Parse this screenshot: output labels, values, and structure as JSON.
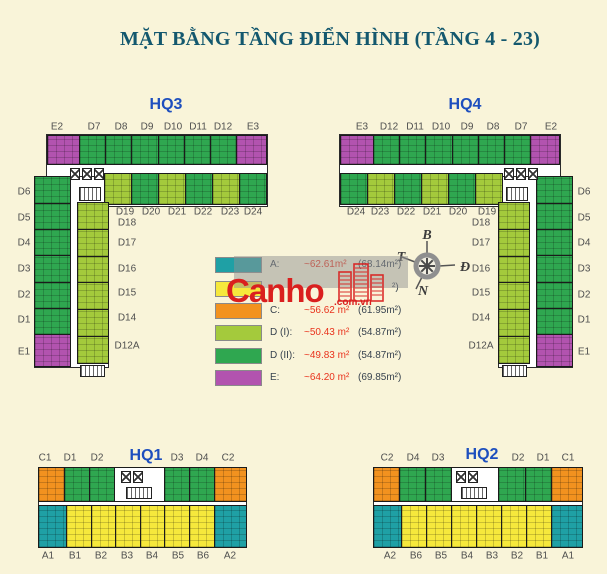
{
  "title": "MẶT BẰNG TẦNG ĐIỂN HÌNH (TẦNG 4 - 23)",
  "colors": {
    "background": "#F9F4D9",
    "title": "#14586E",
    "block_label": "#1E4FBE",
    "unit_label": "#4F4F4F",
    "type_a": "#1FA0A5",
    "type_b": "#F6E83C",
    "type_c": "#F2921F",
    "type_d1": "#A4CA3C",
    "type_d2": "#2FA750",
    "type_e": "#B253AF",
    "legend_value": "#E9331D",
    "legend_paren": "#37424E",
    "watermark_red": "#DA1F1E"
  },
  "blocks": {
    "hq3": {
      "name": "HQ3",
      "top": [
        {
          "id": "E2",
          "type": "e"
        },
        {
          "id": "D7",
          "type": "d2"
        },
        {
          "id": "D8",
          "type": "d2"
        },
        {
          "id": "D9",
          "type": "d2"
        },
        {
          "id": "D10",
          "type": "d2"
        },
        {
          "id": "D11",
          "type": "d2"
        },
        {
          "id": "D12",
          "type": "d2"
        },
        {
          "id": "E3",
          "type": "e"
        }
      ],
      "inner": [
        {
          "id": "D19",
          "type": "d1"
        },
        {
          "id": "D20",
          "type": "d2"
        },
        {
          "id": "D21",
          "type": "d1"
        },
        {
          "id": "D22",
          "type": "d2"
        },
        {
          "id": "D23",
          "type": "d1"
        },
        {
          "id": "D24",
          "type": "d2"
        }
      ],
      "outer": [
        {
          "id": "D6",
          "type": "d2"
        },
        {
          "id": "D5",
          "type": "d2"
        },
        {
          "id": "D4",
          "type": "d2"
        },
        {
          "id": "D3",
          "type": "d2"
        },
        {
          "id": "D2",
          "type": "d2"
        },
        {
          "id": "D1",
          "type": "d2"
        },
        {
          "id": "E1",
          "type": "e"
        }
      ],
      "innerCol": [
        {
          "id": "D18",
          "type": "d1"
        },
        {
          "id": "D17",
          "type": "d1"
        },
        {
          "id": "D16",
          "type": "d1"
        },
        {
          "id": "D15",
          "type": "d1"
        },
        {
          "id": "D14",
          "type": "d1"
        },
        {
          "id": "D12A",
          "type": "d1"
        }
      ]
    },
    "hq4": {
      "name": "HQ4",
      "top": [
        {
          "id": "E3",
          "type": "e"
        },
        {
          "id": "D12",
          "type": "d2"
        },
        {
          "id": "D11",
          "type": "d2"
        },
        {
          "id": "D10",
          "type": "d2"
        },
        {
          "id": "D9",
          "type": "d2"
        },
        {
          "id": "D8",
          "type": "d2"
        },
        {
          "id": "D7",
          "type": "d2"
        },
        {
          "id": "E2",
          "type": "e"
        }
      ],
      "inner": [
        {
          "id": "D24",
          "type": "d2"
        },
        {
          "id": "D23",
          "type": "d1"
        },
        {
          "id": "D22",
          "type": "d2"
        },
        {
          "id": "D21",
          "type": "d1"
        },
        {
          "id": "D20",
          "type": "d2"
        },
        {
          "id": "D19",
          "type": "d1"
        }
      ],
      "outer": [
        {
          "id": "D6",
          "type": "d2"
        },
        {
          "id": "D5",
          "type": "d2"
        },
        {
          "id": "D4",
          "type": "d2"
        },
        {
          "id": "D3",
          "type": "d2"
        },
        {
          "id": "D2",
          "type": "d2"
        },
        {
          "id": "D1",
          "type": "d2"
        },
        {
          "id": "E1",
          "type": "e"
        }
      ],
      "innerCol": [
        {
          "id": "D18",
          "type": "d1"
        },
        {
          "id": "D17",
          "type": "d1"
        },
        {
          "id": "D16",
          "type": "d1"
        },
        {
          "id": "D15",
          "type": "d1"
        },
        {
          "id": "D14",
          "type": "d1"
        },
        {
          "id": "D12A",
          "type": "d1"
        }
      ]
    },
    "hq1": {
      "name": "HQ1",
      "top": [
        {
          "id": "C1",
          "type": "c"
        },
        {
          "id": "D1",
          "type": "d2"
        },
        {
          "id": "D2",
          "type": "d2"
        },
        {
          "id": "",
          "type": "core"
        },
        {
          "id": "D3",
          "type": "d2"
        },
        {
          "id": "D4",
          "type": "d2"
        },
        {
          "id": "C2",
          "type": "c"
        }
      ],
      "bottom": [
        {
          "id": "A1",
          "type": "a"
        },
        {
          "id": "B1",
          "type": "b"
        },
        {
          "id": "B2",
          "type": "b"
        },
        {
          "id": "B3",
          "type": "b"
        },
        {
          "id": "B4",
          "type": "b"
        },
        {
          "id": "B5",
          "type": "b"
        },
        {
          "id": "B6",
          "type": "b"
        },
        {
          "id": "A2",
          "type": "a"
        }
      ]
    },
    "hq2": {
      "name": "HQ2",
      "top": [
        {
          "id": "C2",
          "type": "c"
        },
        {
          "id": "D4",
          "type": "d2"
        },
        {
          "id": "D3",
          "type": "d2"
        },
        {
          "id": "",
          "type": "core"
        },
        {
          "id": "D2",
          "type": "d2"
        },
        {
          "id": "D1",
          "type": "d2"
        },
        {
          "id": "C1",
          "type": "c"
        }
      ],
      "bottom": [
        {
          "id": "A2",
          "type": "a"
        },
        {
          "id": "B6",
          "type": "b"
        },
        {
          "id": "B5",
          "type": "b"
        },
        {
          "id": "B4",
          "type": "b"
        },
        {
          "id": "B3",
          "type": "b"
        },
        {
          "id": "B2",
          "type": "b"
        },
        {
          "id": "B1",
          "type": "b"
        },
        {
          "id": "A1",
          "type": "a"
        }
      ]
    }
  },
  "legend": {
    "rows": [
      {
        "key": "A",
        "label": "A:",
        "value": "~62.61m²",
        "paren": "(68.14m²)",
        "color_key": "type_a"
      },
      {
        "key": "B",
        "label": "",
        "value": "",
        "paren": "²)",
        "color_key": "type_b"
      },
      {
        "key": "C",
        "label": "C:",
        "value": "~56.62 m²",
        "paren": "(61.95m²)",
        "color_key": "type_c"
      },
      {
        "key": "D (I)",
        "label": "D (I):",
        "value": "~50.43 m²",
        "paren": "(54.87m²)",
        "color_key": "type_d1"
      },
      {
        "key": "D (II)",
        "label": "D (II):",
        "value": "~49.83 m²",
        "paren": "(54.87m²)",
        "color_key": "type_d2"
      },
      {
        "key": "E",
        "label": "E:",
        "value": "~64.20 m²",
        "paren": "(69.85m²)",
        "color_key": "type_e"
      }
    ]
  },
  "compass": {
    "north": "B",
    "east": "Đ",
    "south": "N",
    "west": "T"
  },
  "watermark": {
    "brand": "Canho",
    "suffix": ".com.vn"
  }
}
